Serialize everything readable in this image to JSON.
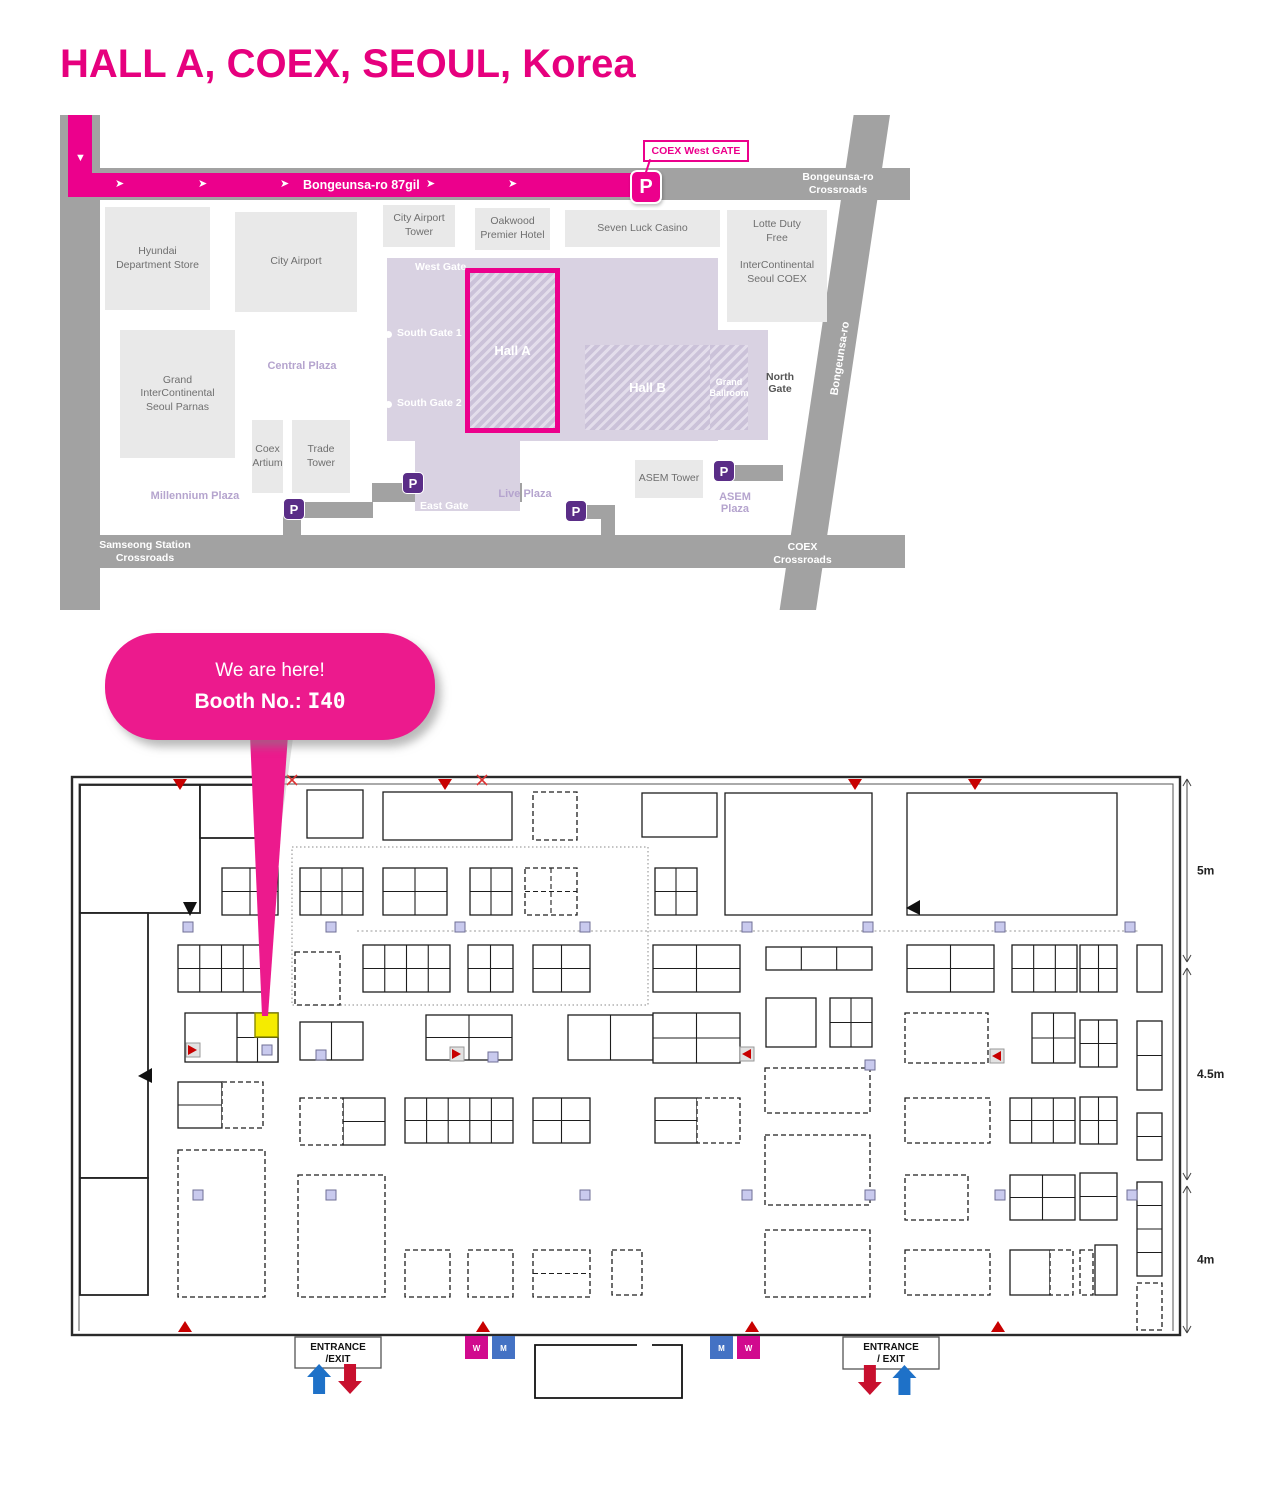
{
  "title": "HALL A, COEX, SEOUL, Korea",
  "colors": {
    "pink": "#EC008C",
    "title_pink": "#E6007E",
    "road_gray": "#A2A2A2",
    "building_gray": "#E9E9E9",
    "coex_purple": "#D9D2E2",
    "parking_purple": "#5A2D87",
    "plaza_text": "#B5A4CE",
    "highlight_yellow": "#F5EB00",
    "restroom_w": "#D10A8E",
    "restroom_m": "#4472C4",
    "arrow_blue": "#1E71C8",
    "arrow_red": "#C8102E",
    "marker_red": "#C80000",
    "pillar": "#C9CAEE"
  },
  "map": {
    "route_label": "Bongeunsa-ro 87gil",
    "callout": "COEX West GATE",
    "diagonal_road_label": "Bongeunsa-ro",
    "crossroads": {
      "top_right": "Bongeunsa-ro\nCrossroads",
      "bottom_left": "Samseong Station\nCrossroads",
      "bottom_right": "COEX\nCrossroads"
    },
    "halls": {
      "hall_a": "Hall A",
      "hall_b": "Hall B",
      "grand_ballroom": "Grand\nBallroom"
    },
    "buildings": [
      {
        "label": "Hyundai\nDepartment Store",
        "x": 45,
        "y": 92,
        "w": 105,
        "h": 103
      },
      {
        "label": "City Airport",
        "x": 175,
        "y": 97,
        "w": 122,
        "h": 100
      },
      {
        "label": "Grand\nInterContinental\nSeoul Parnas",
        "x": 60,
        "y": 215,
        "w": 115,
        "h": 128
      },
      {
        "label": "Coex\nArtium",
        "x": 192,
        "y": 305,
        "w": 31,
        "h": 73
      },
      {
        "label": "Trade\nTower",
        "x": 232,
        "y": 305,
        "w": 58,
        "h": 73
      },
      {
        "label": "City Airport\nTower",
        "x": 323,
        "y": 90,
        "w": 72,
        "h": 42
      },
      {
        "label": "Oakwood\nPremier Hotel",
        "x": 415,
        "y": 93,
        "w": 75,
        "h": 42
      },
      {
        "label": "Seven Luck Casino",
        "x": 505,
        "y": 95,
        "w": 155,
        "h": 37
      },
      {
        "label": "Lotte Duty\nFree\n\nInterContinental\nSeoul COEX",
        "x": 667,
        "y": 95,
        "w": 100,
        "h": 112,
        "topalign": true
      },
      {
        "label": "ASEM Tower",
        "x": 575,
        "y": 345,
        "w": 68,
        "h": 38
      }
    ],
    "gates": [
      {
        "label": "West Gate",
        "x": 355,
        "y": 146
      },
      {
        "label": "South Gate 1",
        "x": 337,
        "y": 212,
        "dot_x": 325,
        "dot_y": 216
      },
      {
        "label": "South Gate 2",
        "x": 337,
        "y": 282,
        "dot_x": 325,
        "dot_y": 286
      },
      {
        "label": "East Gate",
        "x": 360,
        "y": 385
      },
      {
        "label": "North\nGate",
        "x": 706,
        "y": 256,
        "dark": true
      }
    ],
    "plazas": [
      {
        "label": "Central Plaza",
        "x": 182,
        "y": 245,
        "w": 120
      },
      {
        "label": "Millennium Plaza",
        "x": 55,
        "y": 375,
        "w": 160
      },
      {
        "label": "Live Plaza",
        "x": 405,
        "y": 373,
        "w": 120
      },
      {
        "label": "ASEM\nPlaza",
        "x": 645,
        "y": 376,
        "w": 60
      }
    ],
    "parking_purple": [
      [
        223,
        383
      ],
      [
        342,
        357
      ],
      [
        505,
        385
      ],
      [
        653,
        345
      ]
    ],
    "parking_pink": [
      [
        570,
        55
      ]
    ]
  },
  "bubble": {
    "line1": "We are here!",
    "booth_label": "Booth No.: ",
    "booth_no": "I40"
  },
  "floorplan": {
    "outer": [
      72,
      777,
      1108,
      558
    ],
    "inner_path": "M79,1331 L79,784 L1173,784 L1173,1331",
    "rooms": [
      [
        80,
        785,
        120,
        128
      ],
      [
        200,
        785,
        68,
        53
      ],
      [
        80,
        913,
        68,
        265
      ],
      [
        80,
        1178,
        68,
        117
      ]
    ],
    "booths": [
      [
        307,
        790,
        56,
        48
      ],
      [
        383,
        792,
        129,
        48
      ],
      [
        642,
        793,
        75,
        44
      ],
      [
        725,
        793,
        147,
        122
      ],
      [
        907,
        793,
        210,
        122
      ],
      [
        222,
        868,
        56,
        47,
        2,
        2
      ],
      [
        300,
        868,
        63,
        47,
        3,
        2
      ],
      [
        383,
        868,
        64,
        47,
        2,
        2
      ],
      [
        470,
        868,
        42,
        47,
        2,
        2
      ],
      [
        655,
        868,
        42,
        47,
        2,
        2
      ],
      [
        178,
        945,
        87,
        47,
        4,
        2
      ],
      [
        363,
        945,
        87,
        47,
        4,
        2
      ],
      [
        468,
        945,
        45,
        47,
        2,
        2
      ],
      [
        533,
        945,
        57,
        47,
        2,
        2
      ],
      [
        653,
        945,
        87,
        47,
        2,
        2
      ],
      [
        766,
        947,
        106,
        23,
        3,
        1
      ],
      [
        907,
        945,
        87,
        47,
        2,
        2
      ],
      [
        1012,
        945,
        65,
        47,
        3,
        2
      ],
      [
        1080,
        945,
        37,
        47,
        2,
        2
      ],
      [
        1137,
        945,
        25,
        47
      ],
      [
        766,
        998,
        50,
        49
      ],
      [
        830,
        998,
        42,
        49,
        2,
        2
      ],
      [
        185,
        1013,
        93,
        49
      ],
      [
        237,
        1013,
        41,
        49,
        2,
        2
      ],
      [
        300,
        1022,
        63,
        38,
        2,
        1
      ],
      [
        426,
        1015,
        86,
        45,
        2,
        2
      ],
      [
        568,
        1015,
        85,
        45,
        2,
        1
      ],
      [
        653,
        1013,
        87,
        50,
        2,
        2
      ],
      [
        1032,
        1013,
        43,
        50,
        2,
        2
      ],
      [
        1080,
        1020,
        37,
        47,
        2,
        2
      ],
      [
        1137,
        1021,
        25,
        69,
        1,
        2
      ],
      [
        178,
        1082,
        44,
        46,
        1,
        2
      ],
      [
        343,
        1098,
        42,
        47,
        1,
        2
      ],
      [
        405,
        1098,
        108,
        45,
        5,
        2
      ],
      [
        533,
        1098,
        57,
        45,
        2,
        2
      ],
      [
        655,
        1098,
        42,
        45,
        1,
        2
      ],
      [
        1010,
        1098,
        65,
        45,
        3,
        2
      ],
      [
        1080,
        1097,
        37,
        47,
        2,
        2
      ],
      [
        1137,
        1113,
        25,
        47,
        1,
        2
      ],
      [
        1010,
        1175,
        65,
        45,
        2,
        2
      ],
      [
        1080,
        1173,
        37,
        47,
        1,
        2
      ],
      [
        1137,
        1182,
        25,
        94,
        1,
        4
      ],
      [
        1010,
        1250,
        40,
        45
      ],
      [
        1095,
        1245,
        22,
        50
      ]
    ],
    "dashed_booths": [
      [
        533,
        792,
        44,
        48
      ],
      [
        525,
        868,
        52,
        47,
        2,
        2
      ],
      [
        295,
        952,
        45,
        53
      ],
      [
        905,
        1013,
        83,
        50
      ],
      [
        222,
        1082,
        41,
        46
      ],
      [
        300,
        1098,
        43,
        47
      ],
      [
        697,
        1098,
        43,
        45
      ],
      [
        765,
        1068,
        105,
        45
      ],
      [
        905,
        1098,
        85,
        45
      ],
      [
        178,
        1150,
        87,
        147
      ],
      [
        298,
        1175,
        87,
        122
      ],
      [
        765,
        1135,
        105,
        70
      ],
      [
        905,
        1175,
        63,
        45
      ],
      [
        405,
        1250,
        45,
        47
      ],
      [
        468,
        1250,
        45,
        47
      ],
      [
        533,
        1250,
        57,
        47,
        1,
        2
      ],
      [
        612,
        1250,
        30,
        45
      ],
      [
        765,
        1230,
        105,
        67
      ],
      [
        905,
        1250,
        85,
        45
      ],
      [
        1050,
        1250,
        23,
        45
      ],
      [
        1080,
        1250,
        13,
        45
      ],
      [
        1137,
        1283,
        25,
        47
      ]
    ],
    "dotted_zones": [
      [
        292,
        847,
        356,
        158
      ]
    ],
    "dotted_lines": [
      [
        357,
        931,
        1140,
        931
      ]
    ],
    "highlight_booth": {
      "x": 255,
      "y": 1013,
      "w": 23,
      "h": 24
    },
    "pillars": [
      [
        183,
        922
      ],
      [
        326,
        922
      ],
      [
        455,
        922
      ],
      [
        580,
        922
      ],
      [
        742,
        922
      ],
      [
        863,
        922
      ],
      [
        995,
        922
      ],
      [
        1125,
        922
      ],
      [
        193,
        1190
      ],
      [
        326,
        1190
      ],
      [
        580,
        1190
      ],
      [
        742,
        1190
      ],
      [
        865,
        1190
      ],
      [
        995,
        1190
      ],
      [
        1127,
        1190
      ],
      [
        262,
        1045
      ],
      [
        316,
        1050
      ],
      [
        488,
        1052
      ],
      [
        865,
        1060
      ]
    ],
    "markers": {
      "red_down": [
        180,
        445,
        855,
        975
      ],
      "red_x": [
        292,
        482
      ],
      "red_up": [
        185,
        483,
        752,
        998
      ],
      "red_right": [
        [
          188,
          1045
        ],
        [
          452,
          1049
        ]
      ],
      "red_left": [
        [
          742,
          1049
        ],
        [
          992,
          1051
        ]
      ],
      "black_left": [
        [
          140,
          1068
        ],
        [
          908,
          900
        ]
      ],
      "black_down": [
        [
          190,
          902
        ]
      ]
    },
    "restroom_y": 1336,
    "restrooms": [
      {
        "x": 465,
        "label": "W"
      },
      {
        "x": 492,
        "label": "M"
      },
      {
        "x": 710,
        "label": "M"
      },
      {
        "x": 737,
        "label": "W"
      }
    ],
    "entrances": [
      {
        "x": 295,
        "y": 1337,
        "w": 86,
        "h": 31,
        "line1": "ENTRANCE",
        "line2": "/EXIT",
        "arrows": [
          "blue-up",
          "red-down"
        ]
      },
      {
        "x": 843,
        "y": 1337,
        "w": 96,
        "h": 32,
        "line1": "ENTRANCE",
        "line2": "/ EXIT",
        "arrows": [
          "red-down",
          "blue-up"
        ]
      }
    ],
    "bottom_room": {
      "x": 535,
      "y": 1345,
      "w": 147,
      "h": 53,
      "gap_from": 637,
      "gap_to": 652
    },
    "dimensions": [
      {
        "from": 779,
        "to": 962,
        "label": "5m"
      },
      {
        "from": 968,
        "to": 1180,
        "label": "4.5m"
      },
      {
        "from": 1186,
        "to": 1333,
        "label": "4m"
      }
    ]
  }
}
